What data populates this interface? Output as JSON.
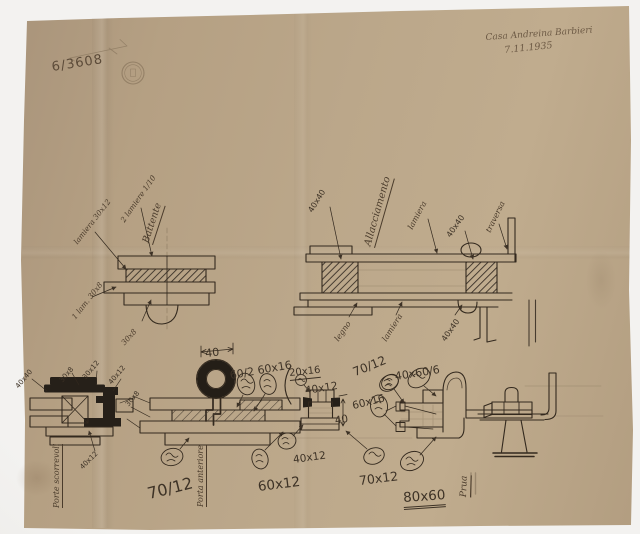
{
  "photo": {
    "backdrop_color": "#f3f2f0",
    "paper_color": "#b5a083",
    "ink_color": "#33291e",
    "pencil_color": "#8b7960"
  },
  "header": {
    "archive_number": "6/3608",
    "note_line1": "Casa Andreina Barbieri",
    "note_line2": "7.11.1935"
  },
  "section_a": {
    "title": "Battente",
    "labels": [
      "lamiera 30x12",
      "2 lamiere 1/10",
      "1 lam. 30x8",
      "30x8"
    ]
  },
  "section_b": {
    "title": "Allacciamento",
    "labels": [
      "40x40",
      "lamiera",
      "40x40",
      "traversa",
      "legno",
      "lamiera",
      "40x40"
    ]
  },
  "section_c": {
    "title": "Porte scorrevoli",
    "labels": [
      "40x40",
      "30x8",
      "30x12",
      "40x12",
      "30x8",
      "40x12"
    ]
  },
  "section_d": {
    "title": "Porta anteriore",
    "dimension": "40",
    "spec": "60/2 60x16",
    "size_large_1": "70/12",
    "size_large_2": "60x12"
  },
  "section_e": {
    "specs": [
      "20x16",
      "40x12",
      "40",
      "40x12",
      "70/12",
      "60x16",
      "70x12"
    ]
  },
  "section_f": {
    "spec_fraction": "40x60/6",
    "size_large": "80x60",
    "word": "Prua"
  }
}
